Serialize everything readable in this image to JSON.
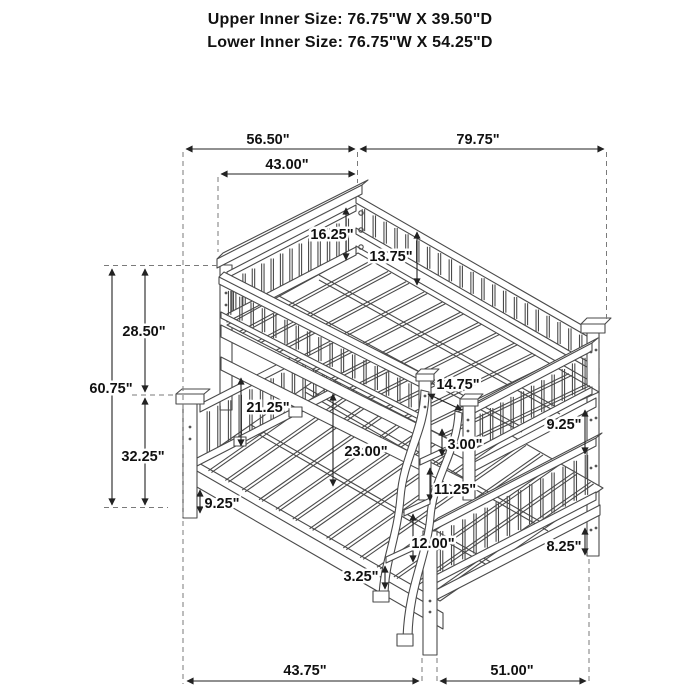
{
  "header": {
    "line1": "Upper Inner Size: 76.75\"W X 39.50\"D",
    "line2": "Lower Inner Size: 76.75\"W X 54.25\"D"
  },
  "dims": {
    "top_left_width": "56.50\"",
    "top_right_length": "79.75\"",
    "headboard_outer_width": "43.00\"",
    "guardrail_height": "16.25\"",
    "guardrail_to_deck": "13.75\"",
    "upper_section_height": "28.50\"",
    "total_height": "60.75\"",
    "lower_section_height": "32.25\"",
    "left_under_clearance": "21.25\"",
    "center_under_clearance": "23.00\"",
    "post_inset": "14.75\"",
    "rail_to_rung": "3.00\"",
    "right_rail_gap": "9.25\"",
    "rung_spacing_upper": "11.25\"",
    "rung_spacing_lower": "12.00\"",
    "bottom_rung_to_floor": "3.25\"",
    "left_rail_to_floor": "9.25\"",
    "right_rail_to_floor": "8.25\"",
    "bottom_left_depth": "43.75\"",
    "bottom_right_length": "51.00\""
  },
  "colors": {
    "line_art": "#4a4a4a",
    "dimension": "#222222",
    "extension_dash": "#7a7a7a"
  }
}
